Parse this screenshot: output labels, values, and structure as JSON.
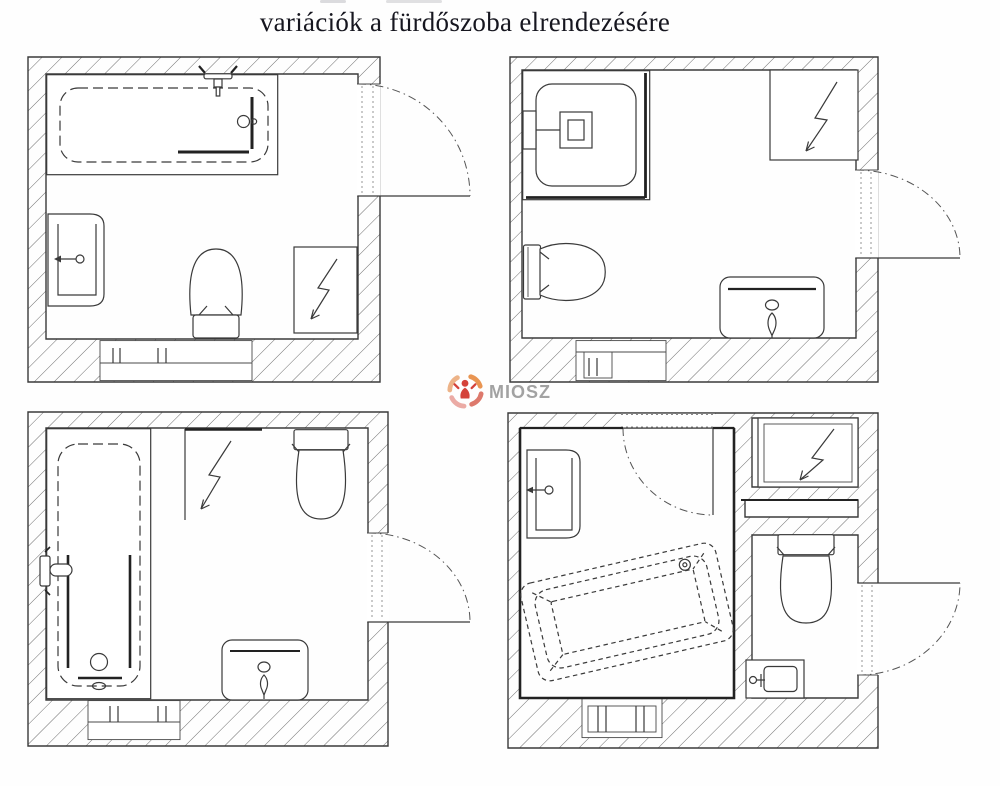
{
  "title": "variációk a fürdőszoba elrendezésére",
  "watermark": {
    "text": "miosz"
  },
  "colors": {
    "line": "#3a3a3a",
    "hatch": "#6e6e6e",
    "background": "#fefefe",
    "watermark_text": "#9b9b9b",
    "logo_orange": "#e78a3f",
    "logo_coral": "#d96a5c",
    "logo_pink": "#eaa6a0",
    "logo_red": "#d4423a"
  },
  "diagram": {
    "type": "floor-plan-variations",
    "plans": [
      {
        "id": "top-left",
        "fixtures": [
          "bathtub along top wall",
          "wall-hung washbasin left",
          "toilet bottom center",
          "washing-machine square bottom right",
          "door on right wall swinging out",
          "radiator window niche in bottom wall"
        ]
      },
      {
        "id": "top-right",
        "fixtures": [
          "corner shower cabin top left",
          "washing-machine square top right",
          "toilet on left wall",
          "washbasin on bottom wall",
          "door on right wall swinging out",
          "radiator window niche in bottom wall"
        ]
      },
      {
        "id": "bottom-left",
        "fixtures": [
          "vertical bathtub along left wall",
          "washing-machine niche top center",
          "toilet on top wall",
          "washbasin on bottom wall",
          "door on right wall swinging out",
          "radiator window niche in bottom wall"
        ]
      },
      {
        "id": "bottom-right",
        "fixtures": [
          "washbasin top left",
          "rotated bathtub (dashed) lower left room",
          "interior door in top wall",
          "washing-machine niche top right",
          "shelf pass-through",
          "toilet in WC room",
          "small hand basin bottom right",
          "entry door on right wall",
          "radiator niche in bottom wall"
        ]
      }
    ]
  }
}
